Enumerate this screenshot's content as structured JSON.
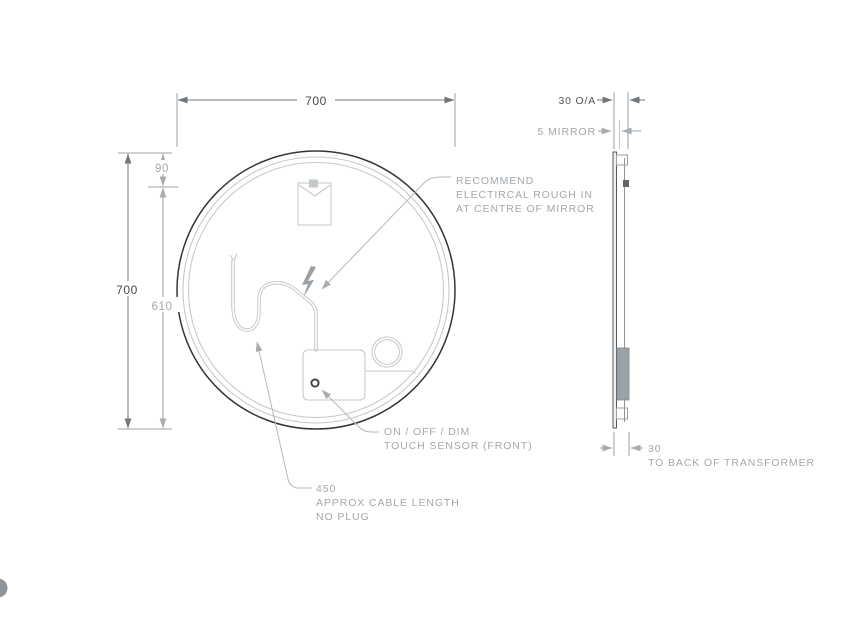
{
  "front_view": {
    "dim_width": "700",
    "dim_height": "700",
    "dim_hook_offset": "90",
    "dim_below_hook": "610",
    "annotations": {
      "rough_in": [
        "RECOMMEND",
        "ELECTIRCAL ROUGH IN",
        "AT CENTRE OF MIRROR"
      ],
      "touch_sensor": [
        "ON / OFF / DIM",
        "TOUCH SENSOR (FRONT)"
      ],
      "cable": [
        "450",
        "APPROX CABLE LENGTH",
        "NO PLUG"
      ]
    }
  },
  "side_view": {
    "dim_overall": "30 O/A",
    "dim_mirror": "5 MIRROR",
    "dim_transformer": "30",
    "transformer_note": "TO BACK OF TRANSFORMER"
  },
  "colors": {
    "outline_dark": "#33373a",
    "text_dark": "#46494c",
    "text_gray": "#a2a8ac",
    "line_light": "#c5cacc",
    "dim_line": "#70767a",
    "transformer_fill": "#9ba1a4"
  }
}
